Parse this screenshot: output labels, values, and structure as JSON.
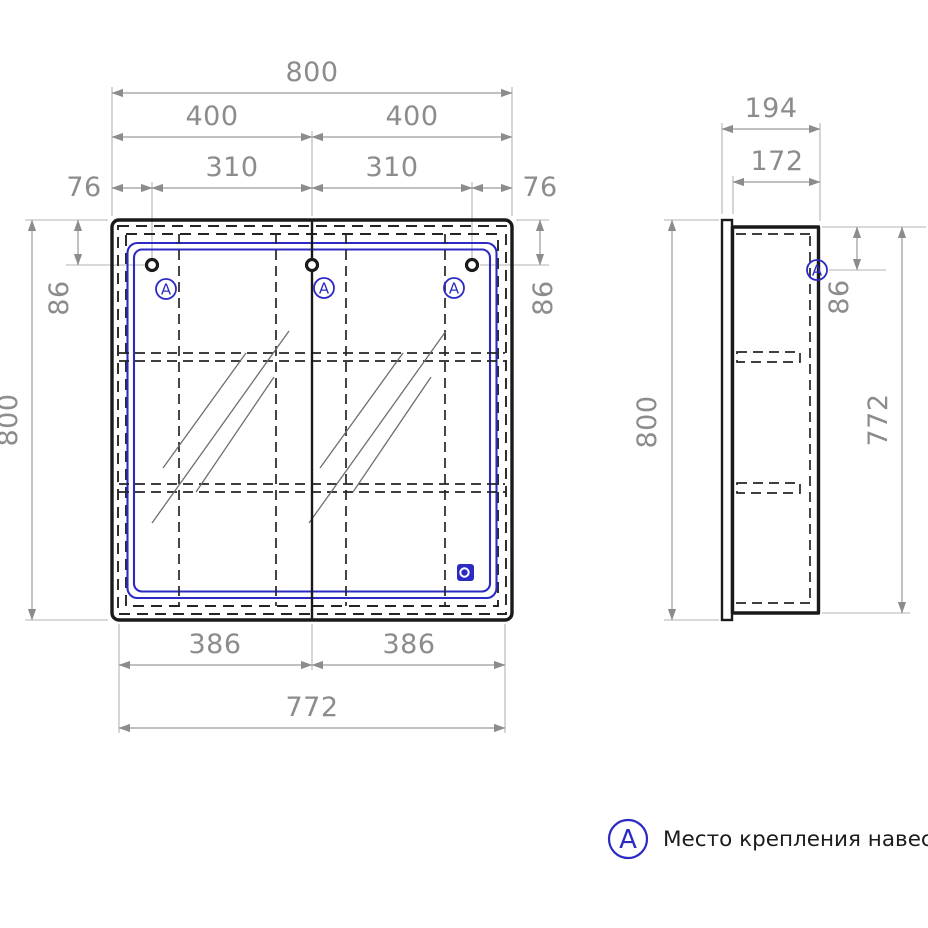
{
  "front_view": {
    "dims": {
      "overall_width": "800",
      "half_width_left": "400",
      "half_width_right": "400",
      "hook_spacing_left": "310",
      "hook_spacing_right": "310",
      "edge_offset_left": "76",
      "edge_offset_right": "76",
      "hook_top_offset_left": "86",
      "hook_top_offset_right": "86",
      "overall_height": "800",
      "door_width_left": "386",
      "door_width_right": "386",
      "doors_total_width": "772"
    },
    "markers": [
      "А",
      "А",
      "А"
    ]
  },
  "side_view": {
    "dims": {
      "overall_depth": "194",
      "body_depth": "172",
      "hook_top_offset": "86",
      "overall_height": "800",
      "body_height": "772"
    },
    "marker": "А"
  },
  "legend": {
    "marker": "А",
    "label": "Место крепления навесов"
  },
  "colors": {
    "drawing_line": "#1a1a1a",
    "hidden_line": "#242424",
    "accent_blue": "#2b2bc4",
    "dimension_gray": "#8c8c8c",
    "extension_gray": "#b3b3b3",
    "background": "#ffffff"
  }
}
